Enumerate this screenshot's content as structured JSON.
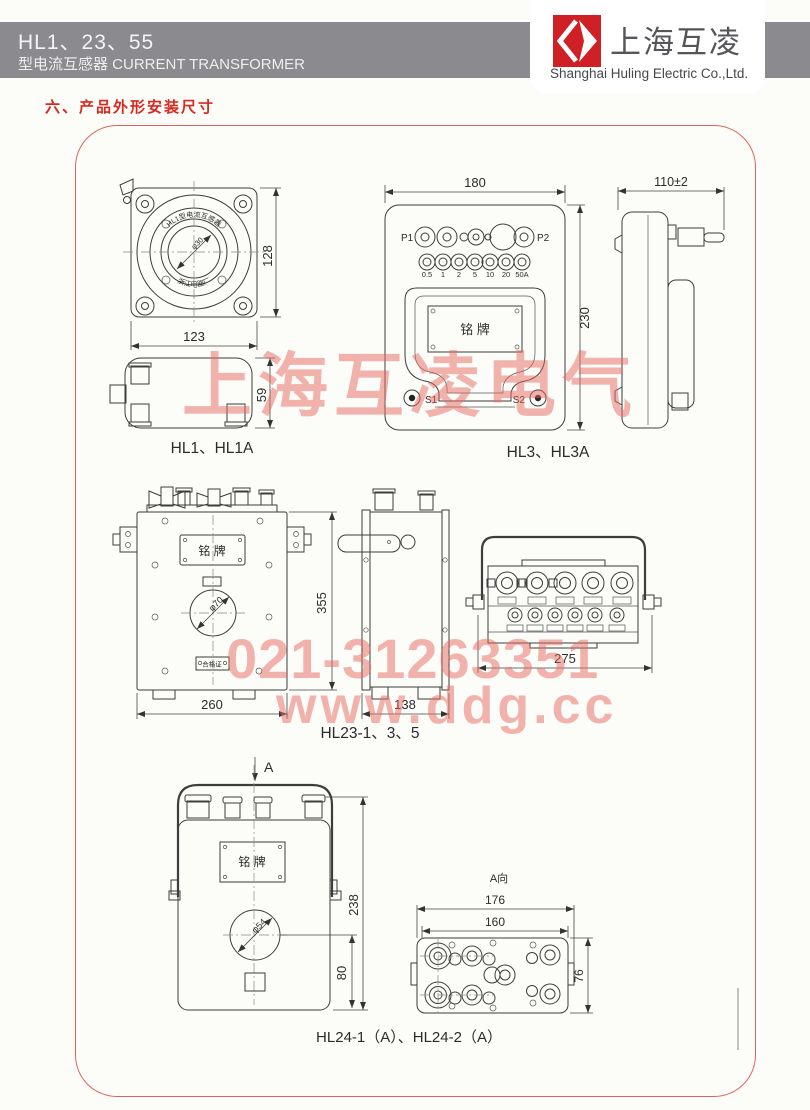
{
  "header": {
    "model": "HL1、23、55",
    "subtitle": "型电流互感器 CURRENT TRANSFORMER",
    "brand": "上海互凌",
    "company": "Shanghai Huling Electric Co.,Ltd.",
    "logo_color": "#cf2026",
    "bar_color": "#8b8b8f"
  },
  "section_title": "六、产品外形安装尺寸",
  "watermarks": {
    "brand": "上海互凌电气",
    "phone": "021-31263351",
    "web": "www.ddg.cc",
    "color": "#e86860"
  },
  "figures": {
    "hl1": {
      "label": "HL1、HL1A",
      "arc_top": "HL1型电流互感器",
      "arc_bottom": "浙江电器厂",
      "center_dim": "φ30",
      "dim_width": "123",
      "dim_height": "128",
      "dim_depth": "59"
    },
    "hl3": {
      "label": "HL3、HL3A",
      "p1": "P1",
      "p2": "P2",
      "s1": "S1",
      "s2": "S2",
      "taps": [
        "0.5",
        "1",
        "2",
        "5",
        "10",
        "20",
        "50A"
      ],
      "nameplate": "铭  牌",
      "dim_width": "180",
      "dim_height": "230",
      "dim_depth": "110±2"
    },
    "hl23": {
      "label": "HL23-1、3、5",
      "nameplate": "铭  牌",
      "cert": "合格证",
      "hole": "φ70",
      "dim_width": "260",
      "dim_height": "355",
      "dim_depth": "138",
      "dim_top": "275"
    },
    "hl24": {
      "label": "HL24-1（A）、HL24-2（A）",
      "view_arrow": "A",
      "view_label": "A向",
      "nameplate": "铭  牌",
      "hole": "φ54",
      "dim_height": "238",
      "dim_lower": "80",
      "dim_w1": "176",
      "dim_w2": "160",
      "dim_h": "76"
    }
  }
}
